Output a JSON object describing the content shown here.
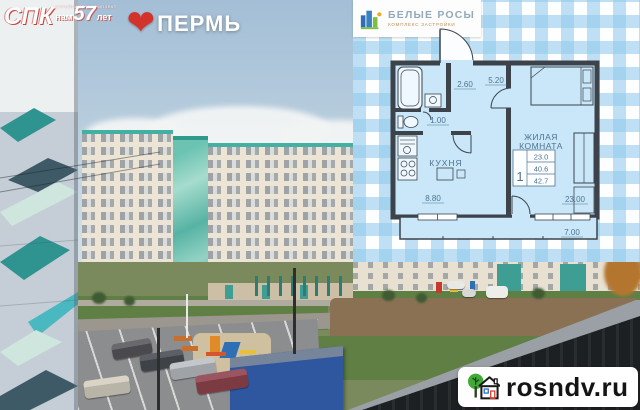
{
  "brand": {
    "developer_tagline": "СТРОЙПАНЕЛЬКОМПЛЕКТ",
    "developer_name": "СПК",
    "years_prefix": "нам",
    "years_number": "57",
    "years_suffix": "лет",
    "city": "ПЕРМЬ"
  },
  "complex": {
    "name": "БЕЛЫЕ РОСЫ",
    "subtitle": "КОМПЛЕКС ЗАСТРОЙКИ"
  },
  "floorplan": {
    "labels": {
      "bath_dim": "2.60",
      "hall_dim": "5.20",
      "wc_dim": "1.00",
      "kitchen_name": "КУХНЯ",
      "kitchen_area": "8.80",
      "living_line1": "ЖИЛАЯ",
      "living_line2": "КОМНАТА",
      "living_dim": "23.00",
      "balcony_dim": "7.00"
    },
    "spec": {
      "rooms": "1",
      "living_area": "23.0",
      "area_no_balcony": "40.6",
      "total_area": "42.7"
    }
  },
  "watermark": {
    "site": "rosndv.ru"
  },
  "colors": {
    "heart_red": "#d2342c",
    "plan_wall": "#3c434b",
    "plan_fill": "#c9e7f8",
    "gingham_blue": "#a9d7f0",
    "container_blue": "#2e57a0",
    "teal_accent": "#43b0a2"
  }
}
